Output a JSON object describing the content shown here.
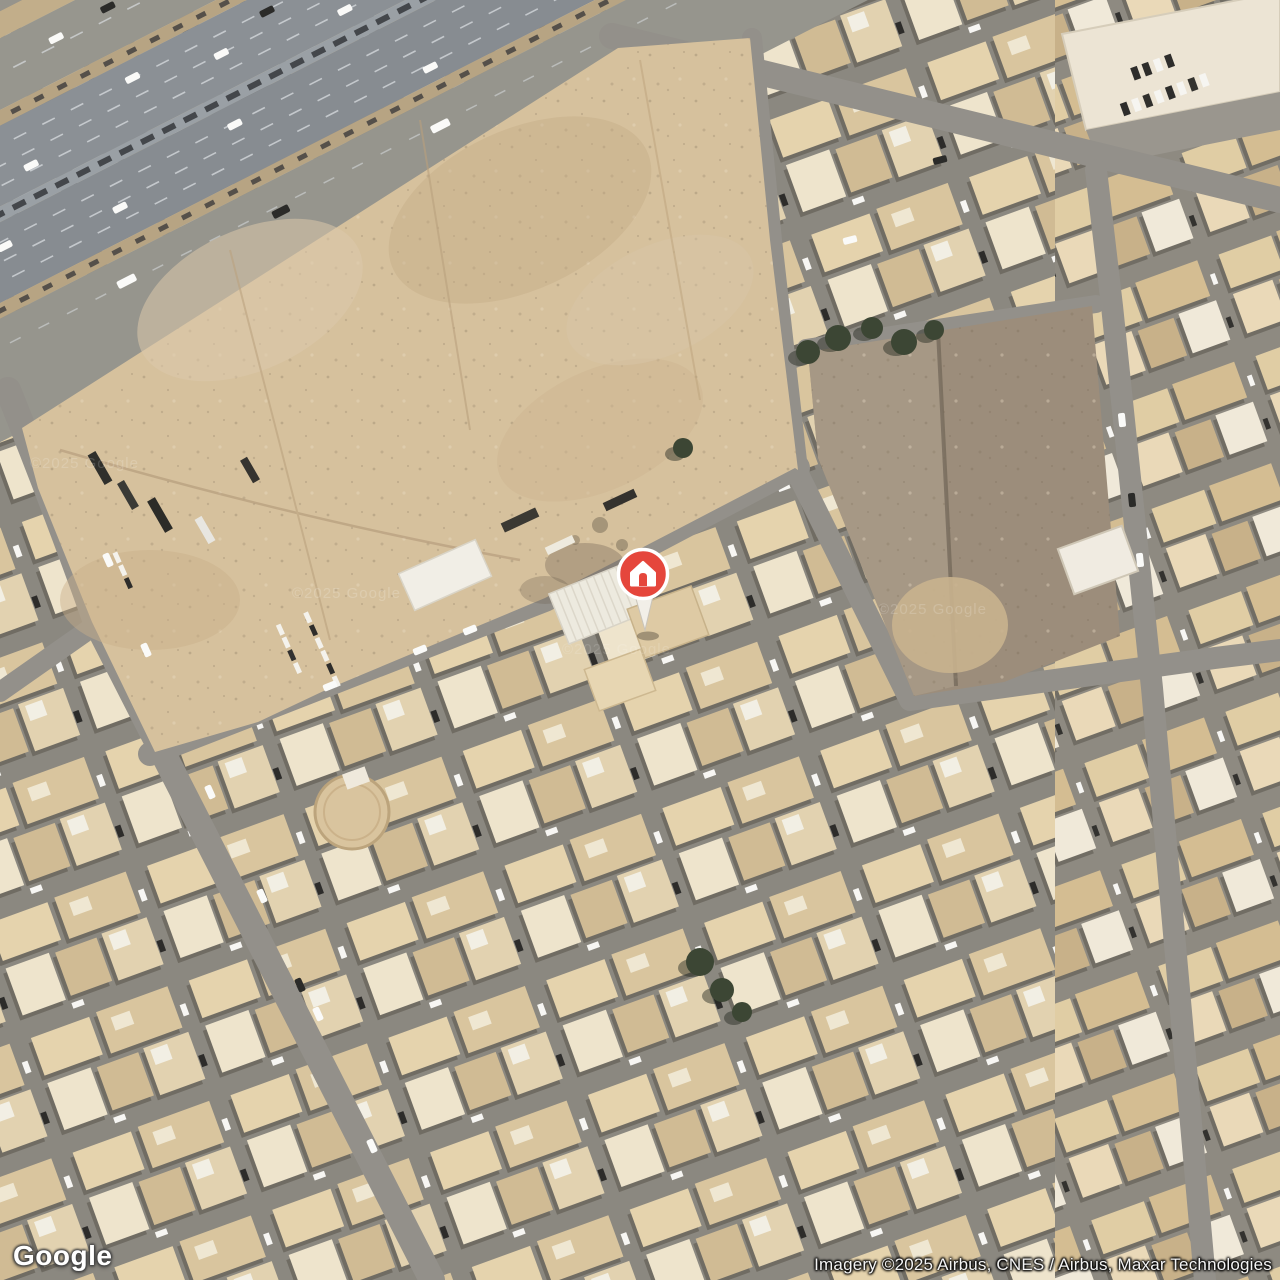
{
  "map": {
    "view_type": "satellite",
    "watermark_text": "©2025 Google",
    "marker": {
      "glyph": "house",
      "pin_color": "#E5463C",
      "glyph_color": "#FFFFFF",
      "stem_color": "#F2EFE8"
    }
  },
  "branding": {
    "logo_text": "Google"
  },
  "attribution": {
    "imagery_credit": "Imagery ©2025 Airbus, CNES / Airbus, Maxar Technologies"
  }
}
